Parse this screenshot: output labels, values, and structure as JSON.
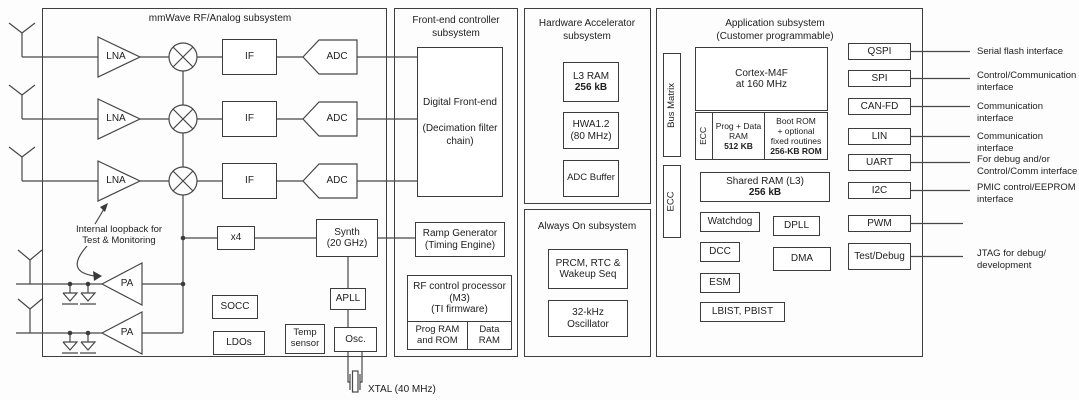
{
  "titles": {
    "mmwave": "mmWave RF/Analog subsystem",
    "frontend": "Front-end controller\nsubsystem",
    "hwa": "Hardware Accelerator\nsubsystem",
    "alwayson": "Always On subsystem",
    "app": "Application subsystem\n(Customer programmable)"
  },
  "mmwave": {
    "lna": "LNA",
    "mixer": "mixer",
    "if": "IF",
    "adc": "ADC",
    "pa": "PA",
    "x4": "x4",
    "synth": "Synth\n(20 GHz)",
    "apll": "APLL",
    "socc": "SOCC",
    "ldos": "LDOs",
    "temp_sensor": "Temp\nsensor",
    "osc": "Osc.",
    "loopback_note": "Internal loopback for\nTest & Monitoring",
    "xtal_label": "XTAL (40 MHz)"
  },
  "frontend": {
    "dfe": "Digital Front-end\n\n(Decimation filter\nchain)",
    "ramp": "Ramp Generator\n(Timing Engine)",
    "rfproc": "RF control processor\n(M3)\n(TI firmware)",
    "prog_ram": "Prog RAM\nand ROM",
    "data_ram": "Data\nRAM"
  },
  "hwa": {
    "l3ram_name": "L3 RAM",
    "l3ram_size": "256 kB",
    "hwa_core": "HWA1.2\n(80 MHz)",
    "adc_buffer": "ADC Buffer"
  },
  "alwayson": {
    "prcm": "PRCM, RTC &\nWakeup Seq",
    "osc32k": "32-kHz\nOscillator"
  },
  "app": {
    "bus_matrix": "Bus Matrix",
    "ecc_side": "ECC",
    "cortex": "Cortex-M4F\nat 160 MHz",
    "ecc_ram": "ECC",
    "prog_data_name": "Prog + Data\nRAM",
    "prog_data_size": "512 KB",
    "boot_rom_name": "Boot ROM\n+ optional\nfixed routines",
    "boot_rom_size": "256-KB ROM",
    "shared_ram_name": "Shared RAM (L3)",
    "shared_ram_size": "256 kB",
    "watchdog": "Watchdog",
    "dpll": "DPLL",
    "dcc": "DCC",
    "dma": "DMA",
    "esm": "ESM",
    "lbist": "LBIST, PBIST"
  },
  "peripherals": [
    {
      "label": "QSPI",
      "desc": "Serial flash interface"
    },
    {
      "label": "SPI",
      "desc": "Control/Communication\ninterface"
    },
    {
      "label": "CAN-FD",
      "desc": "Communication interface"
    },
    {
      "label": "LIN",
      "desc": "Communication interface"
    },
    {
      "label": "UART",
      "desc": "For debug and/or\nControl/Comm interface"
    },
    {
      "label": "I2C",
      "desc": "PMIC control/EEPROM\ninterface"
    },
    {
      "label": "PWM",
      "desc": ""
    },
    {
      "label": "Test/Debug",
      "desc": "JTAG for debug/\ndevelopment"
    }
  ]
}
